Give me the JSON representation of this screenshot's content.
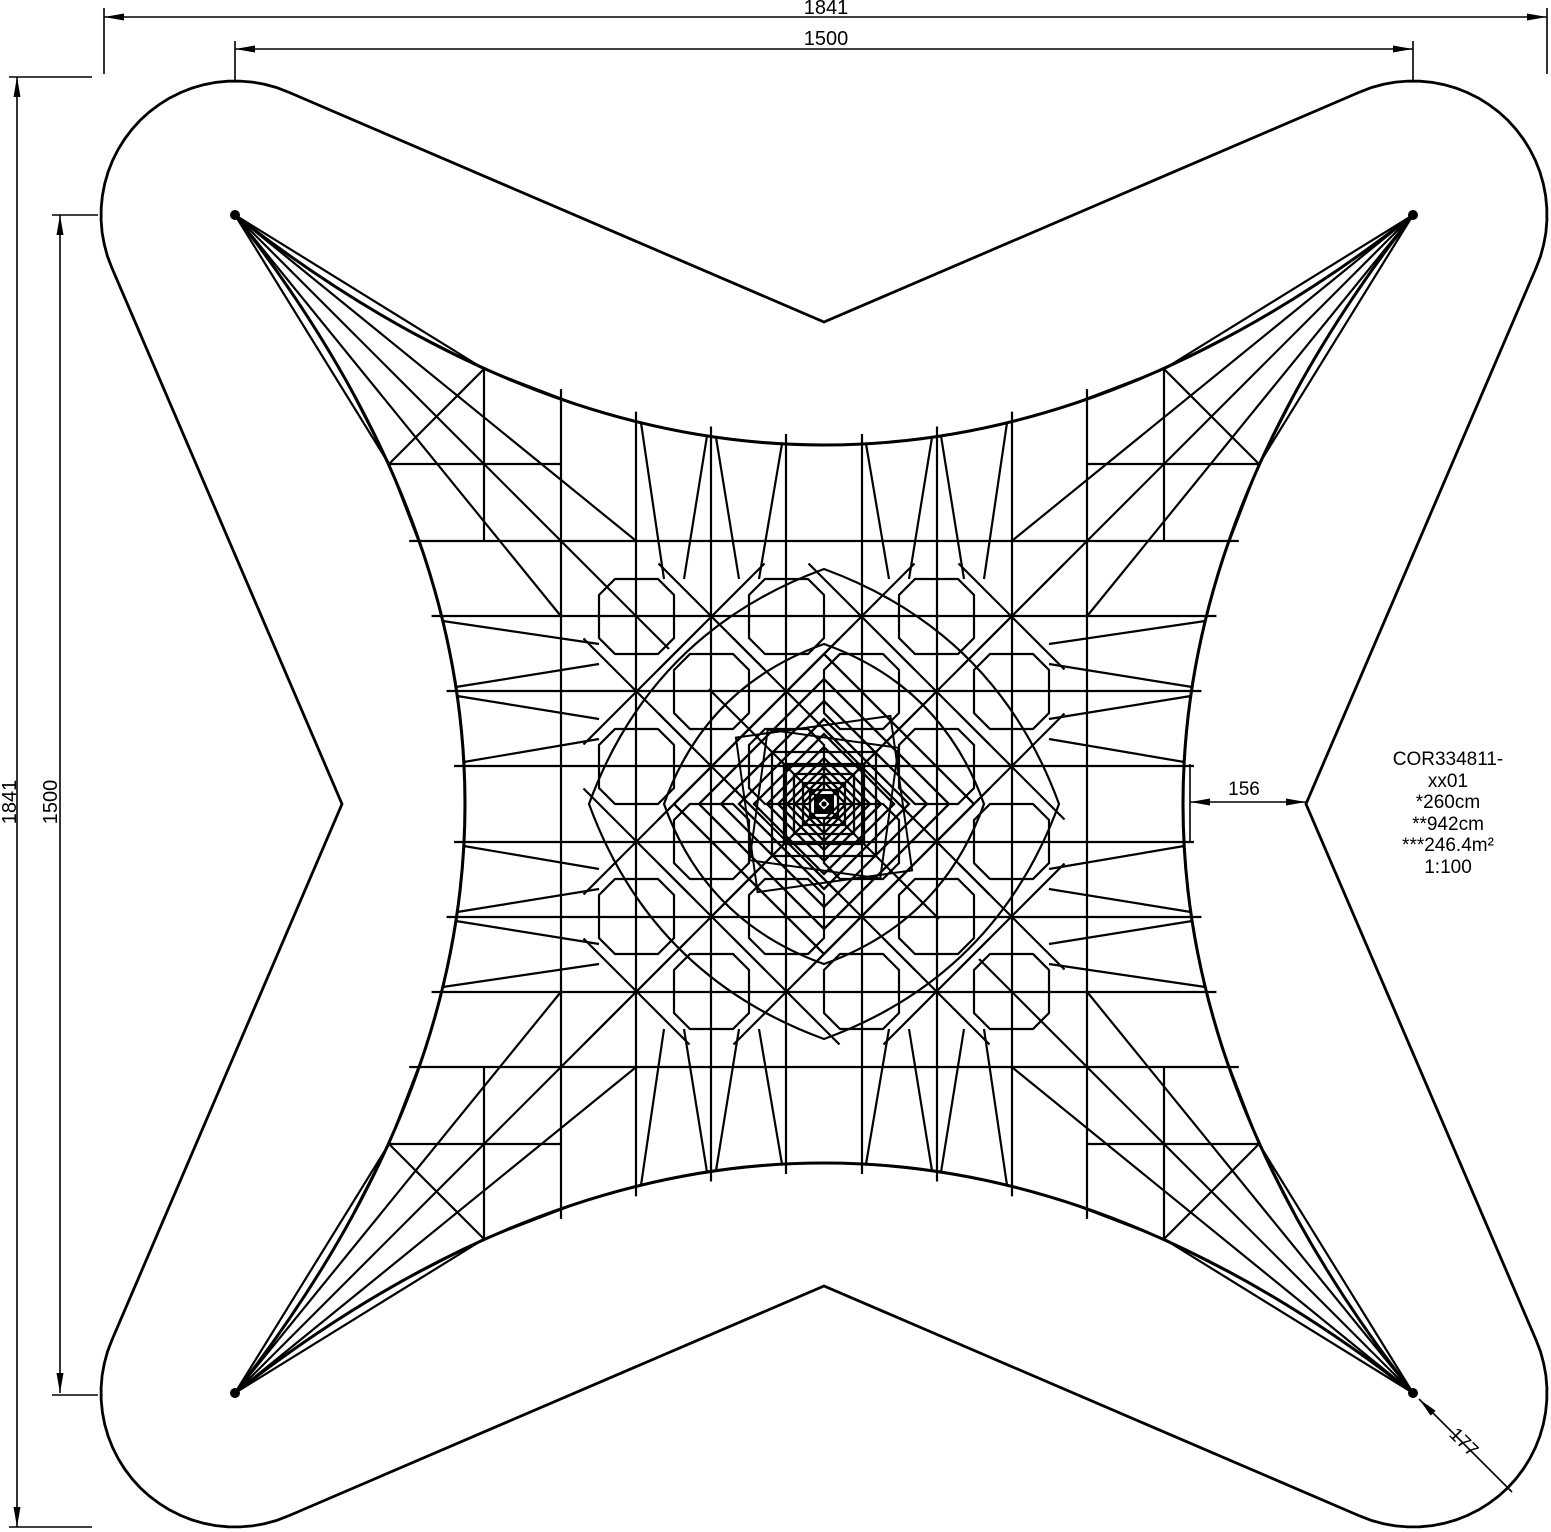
{
  "drawing": {
    "title_block": {
      "part_number": "COR334811-xx01",
      "note_height": "*260cm",
      "note_length": "**942cm",
      "note_area": "***246.4m²",
      "scale": "1:100"
    },
    "dimensions": {
      "outer_width": "1841",
      "inner_width": "1500",
      "outer_height": "1841",
      "inner_height": "1500",
      "edge_offset": "156",
      "corner_radius": "177"
    },
    "colors": {
      "line": "#000000",
      "background": "#ffffff"
    }
  }
}
